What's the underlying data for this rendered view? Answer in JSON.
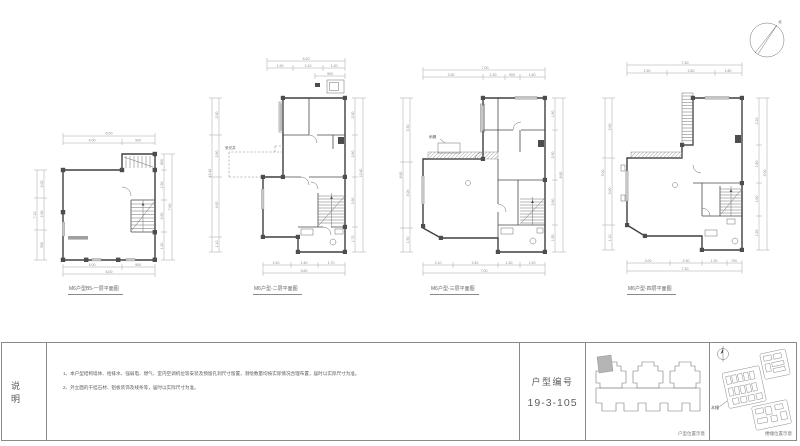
{
  "sheet": {
    "bg": "#ffffff"
  },
  "north": {
    "label": "北"
  },
  "plans": [
    {
      "title": "M6户型B5-一层平面图",
      "dims": [
        "6.00",
        "4.00",
        "900",
        "2.00",
        "2.30",
        "900",
        "7.10",
        "800",
        "1.50",
        "2.60",
        "1.20",
        "7.60",
        "4.00",
        "900",
        "6.00"
      ]
    },
    {
      "title": "M6户型-二层平面图",
      "label": "采光井",
      "dims": [
        "5.20",
        "1.90",
        "2.10",
        "1.20",
        "2.50",
        "2.80",
        "4.00",
        "1.10",
        "10.40",
        "2.50",
        "2.80",
        "3.30",
        "1.70",
        "10.40",
        "2.40",
        "1.40",
        "1.70",
        "5.60",
        "900"
      ]
    },
    {
      "title": "M6户型-三层平面图",
      "label": "雨棚",
      "dims": [
        "7.00",
        "3.30",
        "1.30",
        "900",
        "1.60",
        "3.30",
        "4.00",
        "1.50",
        "8.80",
        "1.80",
        "2.90",
        "2.60",
        "1.55",
        "8.80",
        "2.10",
        "2.40",
        "1.30",
        "1.20",
        "7.00"
      ]
    },
    {
      "title": "M6户型-四层平面图",
      "dims": [
        "7.30",
        "1.50",
        "2.60",
        "1.80",
        "2.60",
        "3.00",
        "1.10",
        "9.00",
        "2.20",
        "1.80",
        "1.60",
        "1.55",
        "9.00",
        "2.00",
        "2.30",
        "1.30",
        "700",
        "7.30"
      ]
    }
  ],
  "notes": {
    "heading": "说明",
    "items": [
      "1、本户型结构墙体、给排水、强弱电、燃气、室内空调机位等安装及预留孔洞尺寸留置，测绘数量均按实际情况合理布置，届时以实际尺寸为准。",
      "2、外立面的干挂石材、铝板装饰及线条等，届时以实际尺寸为准。"
    ]
  },
  "titleblock": {
    "label": "户型编号",
    "number": "19-3-105",
    "unit_caption": "户型位置示意",
    "site_caption": "楼幢位置示意",
    "site_tag": "本幢"
  }
}
